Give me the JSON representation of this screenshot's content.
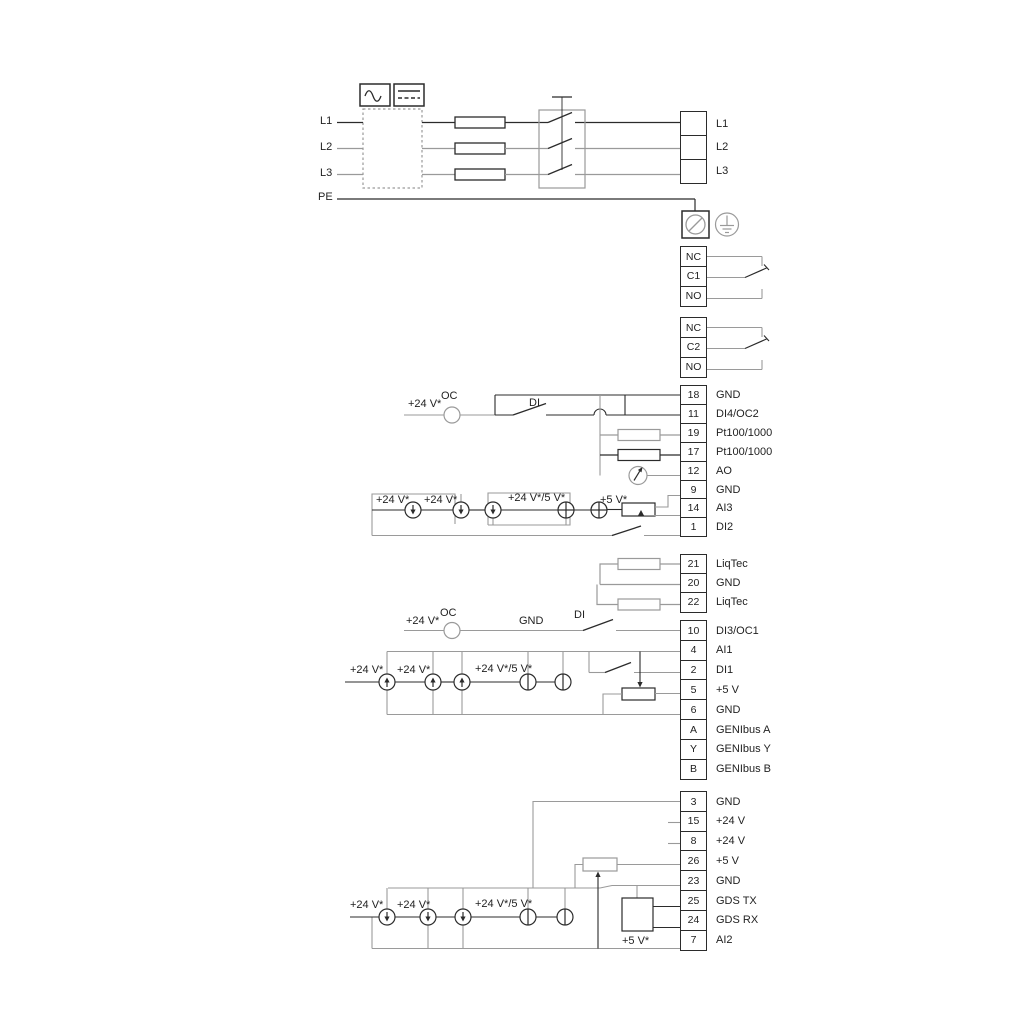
{
  "mains": {
    "l1": "L1",
    "l2": "L2",
    "l3": "L3",
    "pe": "PE",
    "r1": "L1",
    "r2": "L2",
    "r3": "L3"
  },
  "relay1": {
    "a": "NC",
    "b": "C1",
    "c": "NO"
  },
  "relay2": {
    "a": "NC",
    "b": "C2",
    "c": "NO"
  },
  "strip1": [
    {
      "n": "18",
      "t": "GND"
    },
    {
      "n": "11",
      "t": "DI4/OC2"
    },
    {
      "n": "19",
      "t": "Pt100/1000"
    },
    {
      "n": "17",
      "t": "Pt100/1000"
    },
    {
      "n": "12",
      "t": "AO"
    },
    {
      "n": "9",
      "t": "GND"
    },
    {
      "n": "14",
      "t": "AI3"
    },
    {
      "n": "1",
      "t": "DI2"
    }
  ],
  "strip2": [
    {
      "n": "21",
      "t": "LiqTec"
    },
    {
      "n": "20",
      "t": "GND"
    },
    {
      "n": "22",
      "t": "LiqTec"
    }
  ],
  "strip3": [
    {
      "n": "10",
      "t": "DI3/OC1"
    },
    {
      "n": "4",
      "t": "AI1"
    },
    {
      "n": "2",
      "t": "DI1"
    },
    {
      "n": "5",
      "t": "+5 V"
    },
    {
      "n": "6",
      "t": "GND"
    },
    {
      "n": "A",
      "t": "GENIbus A"
    },
    {
      "n": "Y",
      "t": "GENIbus Y"
    },
    {
      "n": "B",
      "t": "GENIbus B"
    }
  ],
  "strip4": [
    {
      "n": "3",
      "t": "GND"
    },
    {
      "n": "15",
      "t": "+24 V"
    },
    {
      "n": "8",
      "t": "+24 V"
    },
    {
      "n": "26",
      "t": "+5 V"
    },
    {
      "n": "23",
      "t": "GND"
    },
    {
      "n": "25",
      "t": "GDS TX"
    },
    {
      "n": "24",
      "t": "GDS RX"
    },
    {
      "n": "7",
      "t": "AI2"
    }
  ],
  "ann": {
    "v24_1": "+24 V*",
    "oc1": "OC",
    "di1": "DI",
    "ai3_v24a": "+24 V*",
    "ai3_v24b": "+24 V*",
    "ai3_mix": "+24 V*/5 V*",
    "ai3_v5": "+5 V*",
    "di3_v24": "+24 V*",
    "di3_oc": "OC",
    "di3_gnd": "GND",
    "di3_di": "DI",
    "ai1_v24a": "+24 V*",
    "ai1_v24b": "+24 V*",
    "ai1_mix": "+24 V*/5 V*",
    "ai2_v24a": "+24 V*",
    "ai2_v24b": "+24 V*",
    "ai2_mix": "+24 V*/5 V*",
    "ai2_v5": "+5 V*"
  },
  "colors": {
    "wire_gray": "#9a9a9a",
    "wire_dark": "#2b2b2b",
    "background": "#ffffff"
  }
}
